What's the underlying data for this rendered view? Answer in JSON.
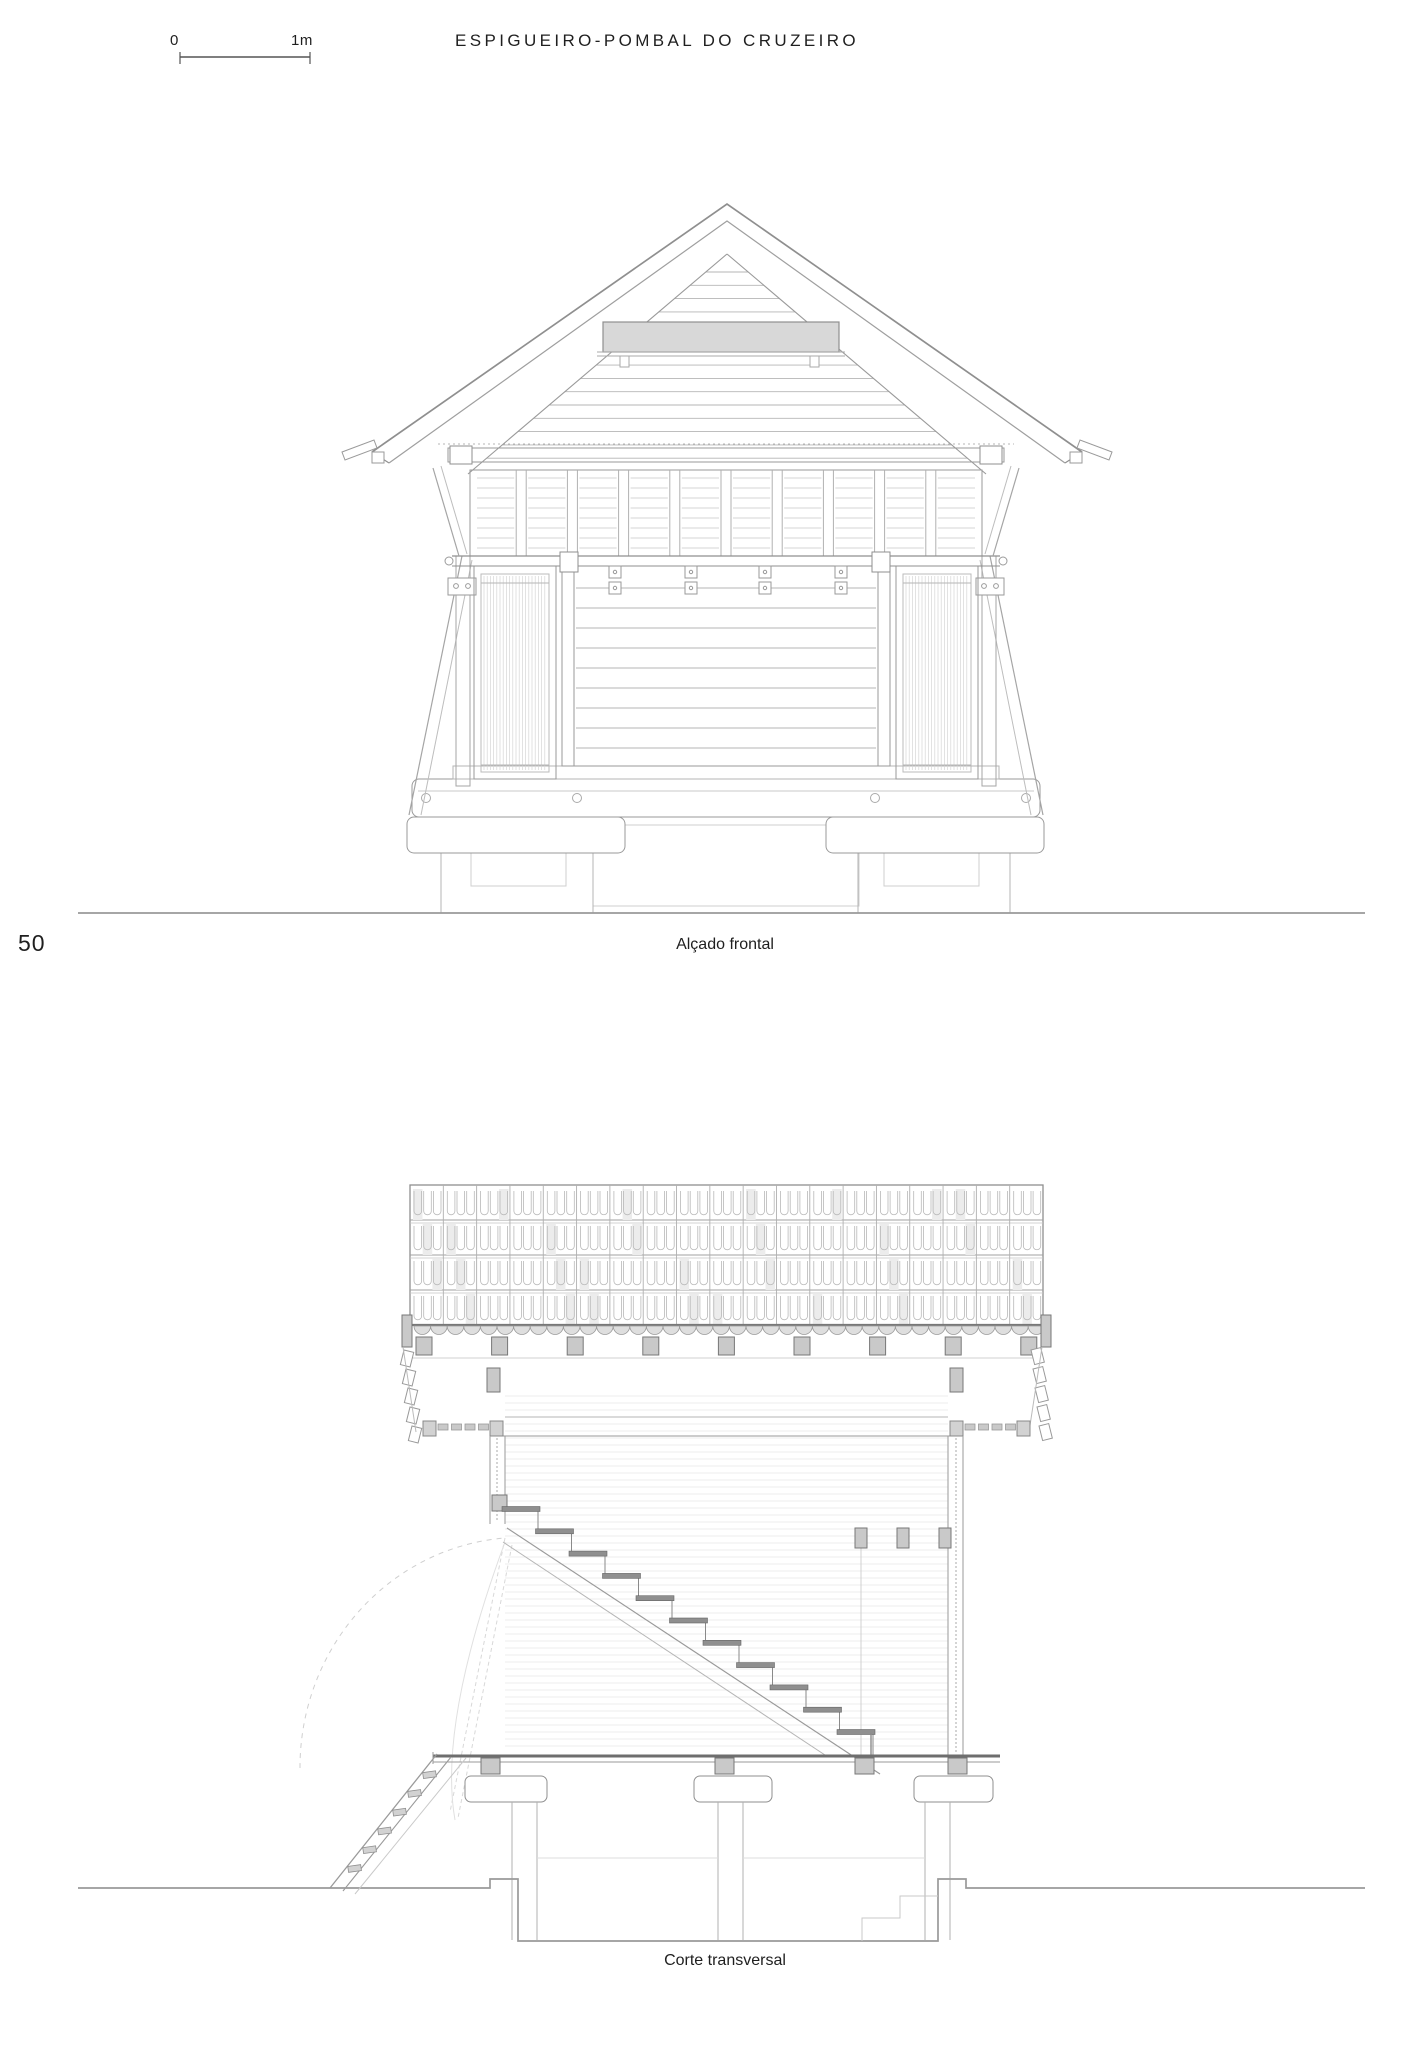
{
  "header": {
    "title": "ESPIGUEIRO-POMBAL DO CRUZEIRO",
    "scale_bar": {
      "start": "0",
      "end": "1m"
    }
  },
  "page_number": "50",
  "figures": {
    "front_elevation": {
      "caption": "Alçado frontal"
    },
    "cross_section": {
      "caption": "Corte transversal"
    }
  },
  "colors": {
    "line": "#9a9a9a",
    "line_medium": "#b5b5b5",
    "line_light": "#d9d9d9",
    "line_faint": "#e7e7e7",
    "line_dark": "#6e6e6e",
    "fill_gray": "#c9c9c9",
    "fill_light": "#e5e5e5",
    "vent_fill": "#d8d8d8",
    "text": "#1f1f1f",
    "background": "#ffffff"
  }
}
